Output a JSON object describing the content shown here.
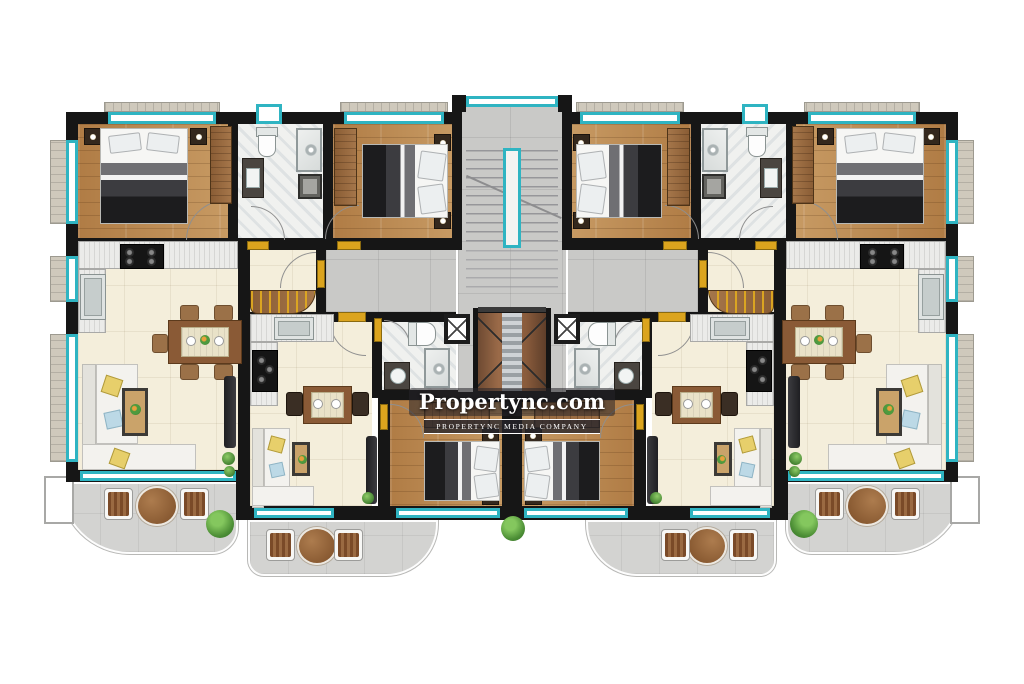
{
  "watermark": {
    "title": "Propertync.com",
    "subtitle": "PROPERTYNC MEDIA COMPANY"
  },
  "palette": {
    "wall": "#161616",
    "teal": "#2fb4c2",
    "wood": "#b9854f",
    "cream": "#f4eedb",
    "marble": "#f0f1ef",
    "gtile": "#c9c9c7",
    "terr": "#d3d3d1",
    "gold": "#dba41e",
    "pyellow": "#e7cf6b",
    "pblue": "#bcd9e6",
    "twood": "#8a5a36"
  }
}
